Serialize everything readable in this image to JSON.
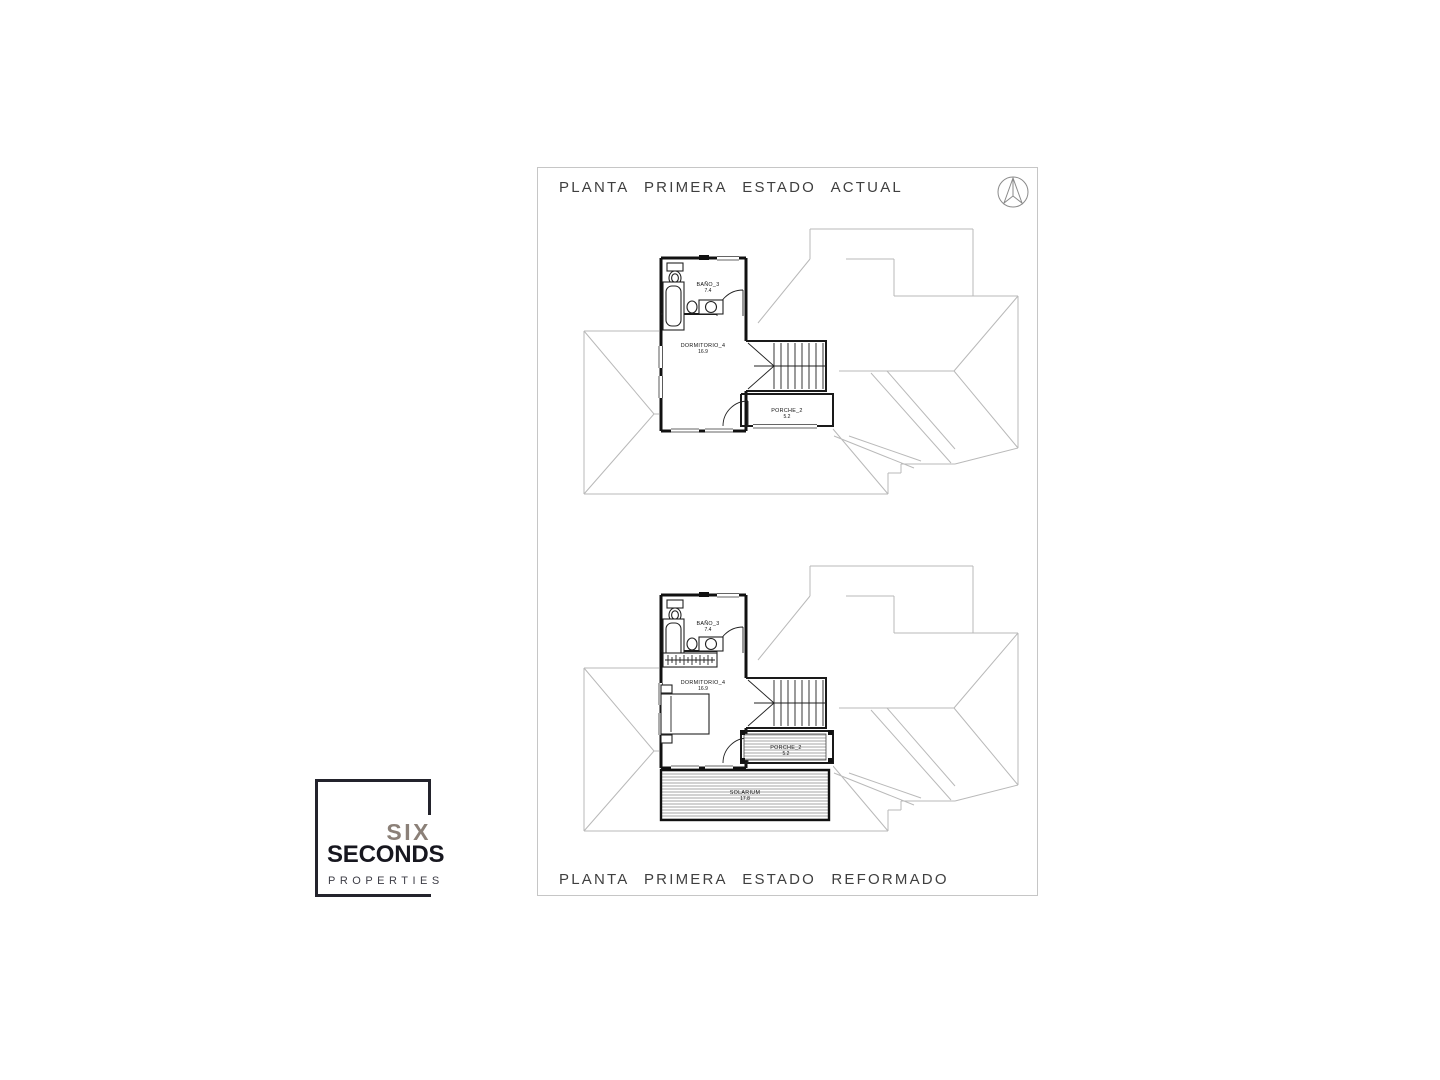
{
  "sheet": {
    "title_top": "PLANTA PRIMERA ESTADO ACTUAL",
    "title_bottom": "PLANTA PRIMERA ESTADO REFORMADO",
    "border_color": "#c6c6c6",
    "line_color": "#111111",
    "roof_line_color": "#b9b9b9"
  },
  "icons": {
    "north": "north-arrow-compass"
  },
  "plans": {
    "actual": {
      "rooms": {
        "bano": {
          "name": "BAÑO_3",
          "area": "7.4"
        },
        "dormitorio": {
          "name": "DORMITORIO_4",
          "area": "16.9"
        },
        "porche": {
          "name": "PORCHE_2",
          "area": "5.2"
        }
      }
    },
    "reformado": {
      "rooms": {
        "bano": {
          "name": "BAÑO_3",
          "area": "7.4"
        },
        "dormitorio": {
          "name": "DORMITORIO_4",
          "area": "16.9"
        },
        "porche": {
          "name": "PORCHE_2",
          "area": "5.2"
        },
        "solarium": {
          "name": "SOLARIUM",
          "area": "17.8"
        }
      }
    }
  },
  "logo": {
    "line1": "SIX",
    "line2": "SECONDS",
    "line3": "PROPERTIES",
    "color_line1": "#8b8078",
    "color_line2": "#17171f",
    "color_line3": "#3d3d46",
    "border_color": "#23232c"
  }
}
